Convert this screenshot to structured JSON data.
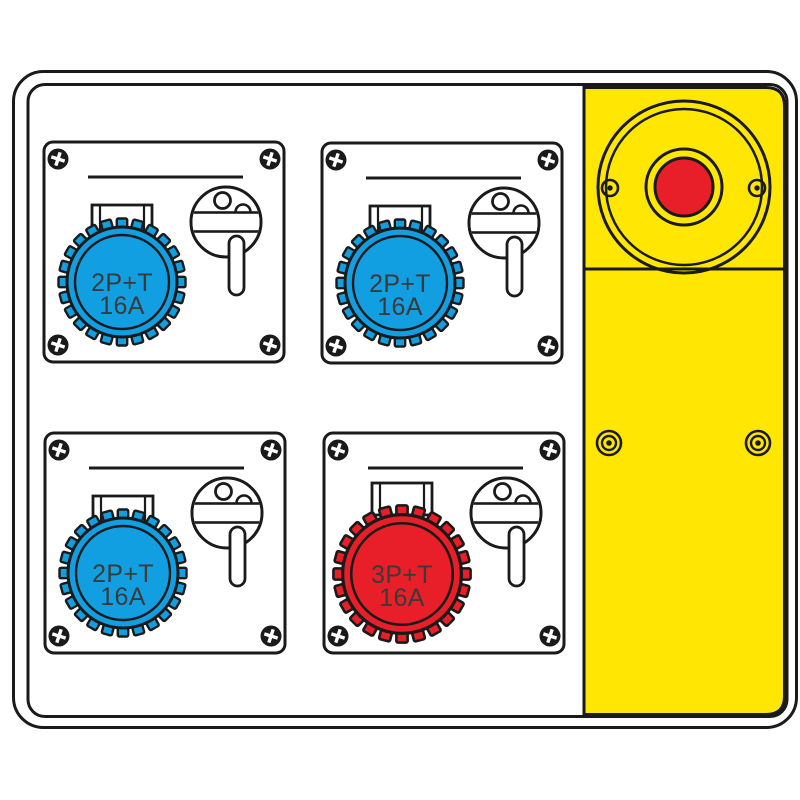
{
  "colors": {
    "blue": "#129FE1",
    "red": "#E81E28",
    "yellow": "#FFE603",
    "outline": "#1A1A1A",
    "label_text": "#3A3A3A",
    "background": "#FFFFFF"
  },
  "modules": [
    {
      "position": "top-left",
      "socket_color": "blue",
      "label_top": "2P+T",
      "label_amp": "16A"
    },
    {
      "position": "top-right",
      "socket_color": "blue",
      "label_top": "2P+T",
      "label_amp": "16A"
    },
    {
      "position": "bottom-left",
      "socket_color": "blue",
      "label_top": "2P+T",
      "label_amp": "16A"
    },
    {
      "position": "bottom-right",
      "socket_color": "red",
      "label_top": "3P+T",
      "label_amp": "16A"
    }
  ]
}
